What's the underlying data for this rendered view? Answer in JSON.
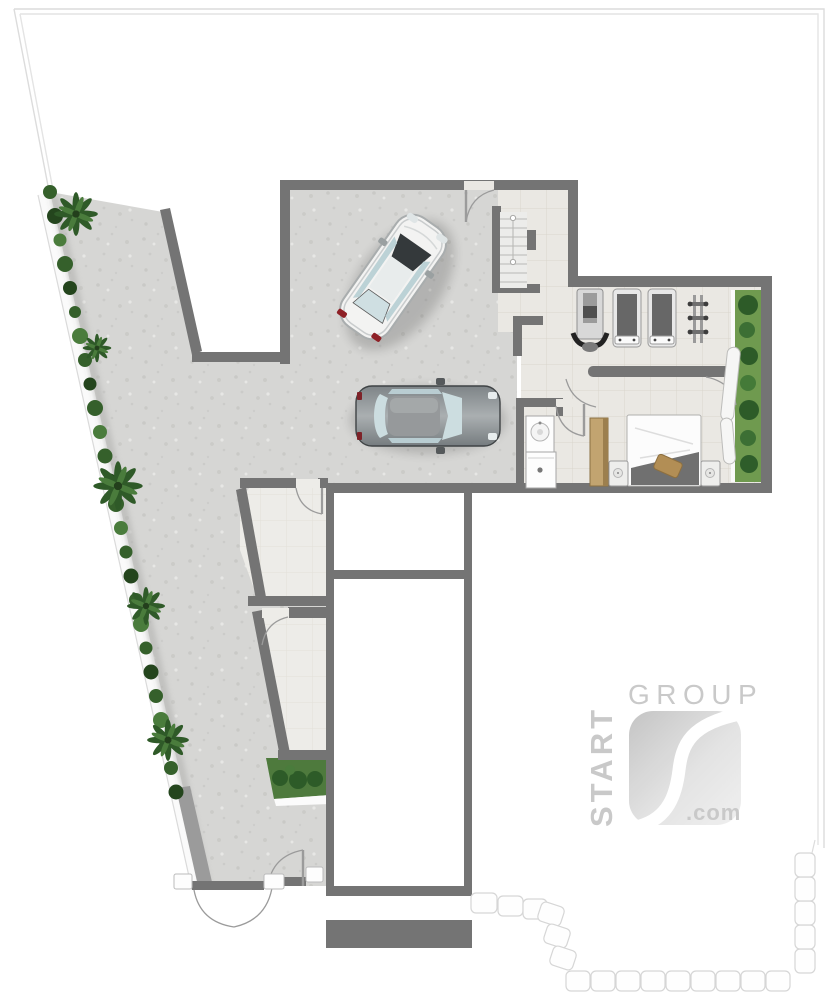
{
  "watermark": {
    "brand_top": "GROUP",
    "brand_vertical": "START",
    "brand_suffix": ".com"
  },
  "colors": {
    "wall": "#747474",
    "paving": "#d6d6d4",
    "tile": "#eae8e3",
    "tile_light": "#edece8",
    "white_room": "#ffffff",
    "plot_line": "#dcdcdc",
    "hedge": "#35602b",
    "planter": "#6f9a4f",
    "planter_strip": "#4e7a3d",
    "wardrobe": "#c2a470",
    "block_wall": "#fefefe",
    "watermark": "#c7c7c7",
    "car_light_body": "#f3f3f2",
    "car_dark_body": "#8d9296",
    "glass": "#ccdde0",
    "taillight": "#8e2026",
    "bed_blanket": "#707070"
  }
}
